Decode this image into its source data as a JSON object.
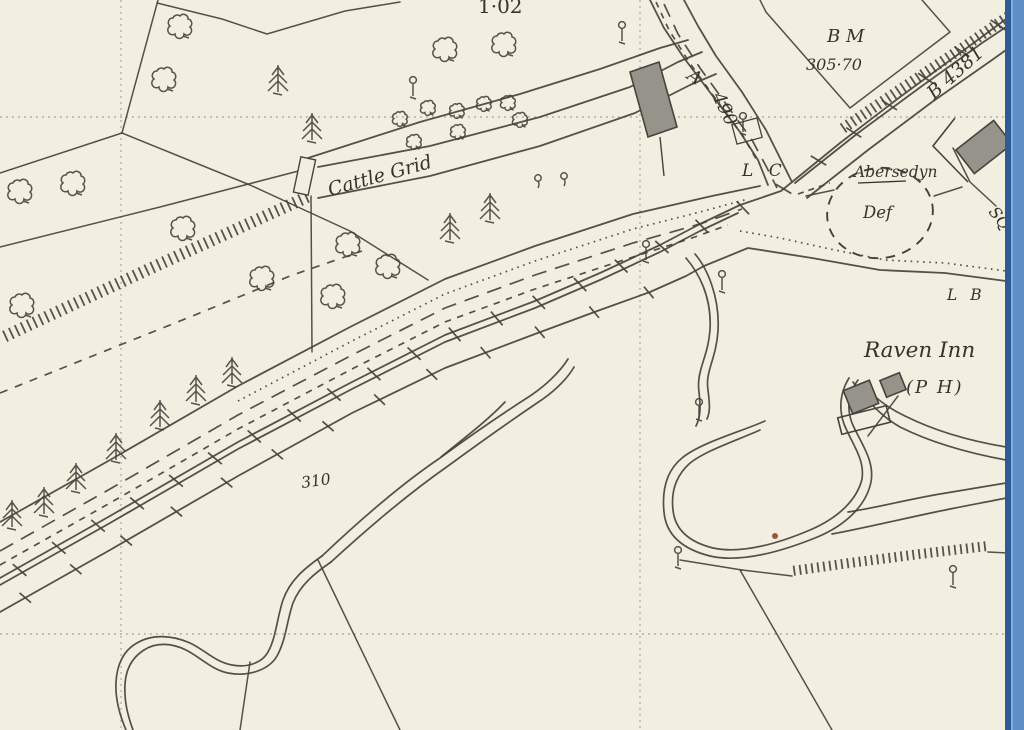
{
  "map": {
    "labels": {
      "parcel_area": "1·02",
      "benchmark_abbr": "B M",
      "benchmark_value": "305·70",
      "road_a_prefix": "A",
      "road_a_number": "490",
      "road_b_number": "B 4381",
      "level_crossing": "L C",
      "cattle_grid": "Cattle Grid",
      "place_name": "Abersedyn",
      "boundary_def": "Def",
      "letter_box": "L B",
      "inn_name": "Raven Inn",
      "inn_type": "(P H)",
      "spot_height": "310",
      "square_partial": "SQ"
    },
    "colors": {
      "paper": "#f2efe1",
      "ink": "#45433c",
      "text": "#35332c",
      "building_fill": "#96938b",
      "grid_dots": "#98927e",
      "edge_dark_blue": "#2c5c95",
      "edge_light_blue": "#5e8ec7",
      "river_dot": "#a2543a"
    },
    "symbols": [
      "deciduous-tree",
      "conifer-tree",
      "telegraph-pole",
      "spring-symbol",
      "railway-hachure",
      "ditch-hachure",
      "cattle-grid-bars",
      "bench-mark",
      "level-crossing-ticks"
    ]
  }
}
